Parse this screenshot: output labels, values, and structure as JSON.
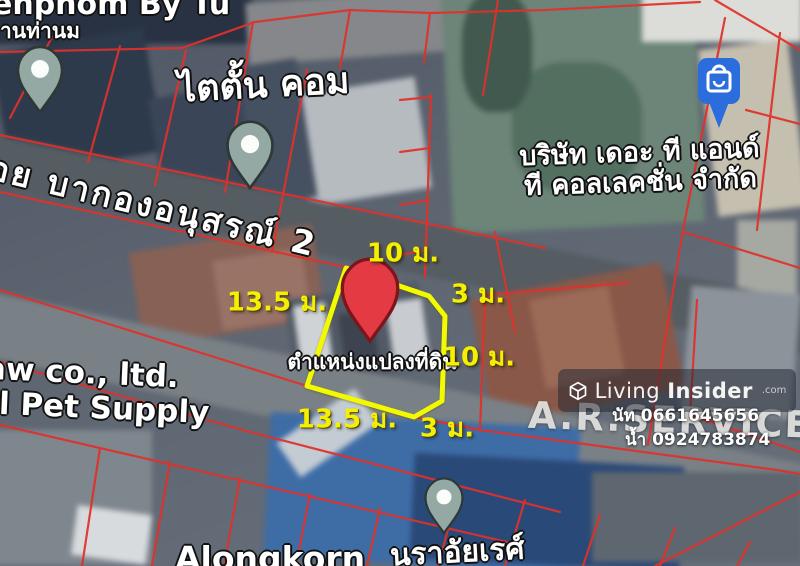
{
  "map_labels": {
    "top_left_line1": "enphom By Tu",
    "top_left_line2": "านท่านม",
    "titan_com": "ไตตั้น คอม",
    "company_line1": "บริษัท เดอะ ที แอนด์",
    "company_line2": "ที คอลเลคชั่น จำกัด",
    "street_name": "อย บากองอนุสรณ์ 2",
    "pet_supply_line1": "aw co., ltd.",
    "pet_supply_line2": "al Pet Supply",
    "ars_service": "A.R.SERVICE CE",
    "bottom_left_business": "Alongkorn",
    "bottom_right_business": "นราอัยเรศ์",
    "plot_location": "ตำแหน่งแปลงที่ดิน"
  },
  "measurements": {
    "top_edge": "10 ม.",
    "top_right_edge": "3 ม.",
    "left_edge": "13.5 ม.",
    "right_edge": "10 ม.",
    "bottom_edge": "13.5 ม.",
    "bottom_right_edge": "3 ม."
  },
  "watermark": {
    "brand_light": "Living",
    "brand_bold": "Insider",
    "brand_suffix": ".com",
    "contacts": [
      {
        "name": "นัท",
        "phone": "0661645656"
      },
      {
        "name": "น้ำ",
        "phone": "0924783874"
      }
    ]
  },
  "colors": {
    "boundary_line": "#e0312b",
    "plot_outline": "#f2fa00",
    "measurement_text": "#f5ef00",
    "location_pin": "#e33a43",
    "poi_pin": "#94a9a4",
    "shop_pin": "#2b6ddd"
  }
}
